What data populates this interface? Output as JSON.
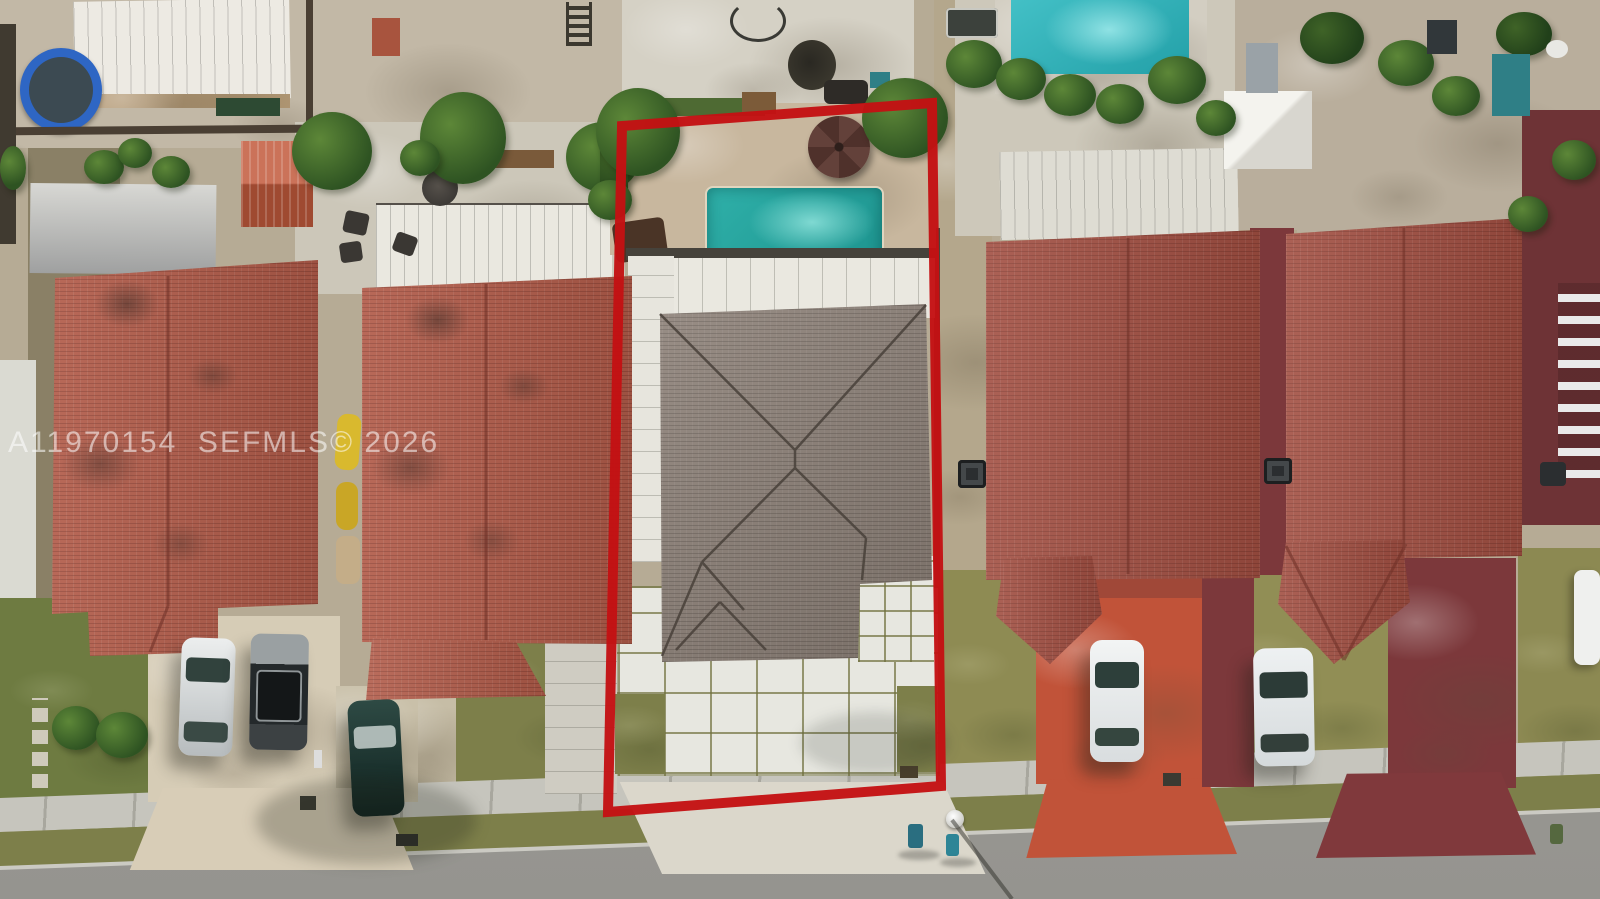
{
  "image": {
    "watermark": "A11970154  SEFMLS© 2026"
  },
  "colors": {
    "outline_red": "#c41113",
    "pool_teal": "#2fb0a9",
    "pool_neighbor_teal": "#43c0c6",
    "roof_red": "#b25c4a",
    "roof_red_dark": "#a24f42",
    "roof_gray": "#8d8178",
    "grass_olive": "#7d7f4a",
    "street_gray": "#9d9c98",
    "sidewalk_gray": "#c6c5bd",
    "driveway_red": "#c15339",
    "driveway_maroon": "#7c383b",
    "travertine_tan": "#c8b79e",
    "white_roof": "#eae8e0",
    "paver_white": "#e7e7e0"
  }
}
